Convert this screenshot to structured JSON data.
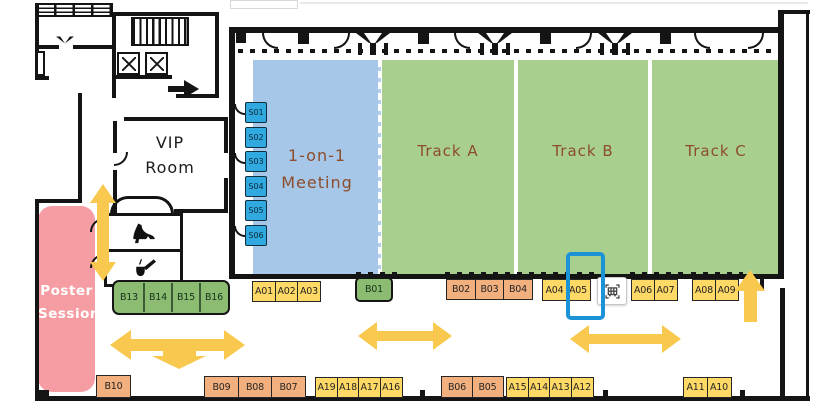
{
  "colors": {
    "wall": "#141414",
    "blue_area": "#A7C7E8",
    "green_area": "#A9CF8F",
    "slot_blue": "#2FA9DF",
    "poster_pink": "#F59DA3",
    "booth_yellow": "#FFD966",
    "booth_orange": "#F2B07E",
    "booth_green": "#8CBC72",
    "arrow_gold": "#F8C94E",
    "highlight_blue": "#1C93D6",
    "label_brown": "#8D4C2C"
  },
  "rooms": {
    "vip": {
      "line1": "VIP",
      "line2": "Room"
    },
    "one_on_one": {
      "line1": "1-on-1",
      "line2": "Meeting"
    },
    "tracks": [
      {
        "label": "Track A"
      },
      {
        "label": "Track B"
      },
      {
        "label": "Track C"
      }
    ],
    "poster": {
      "line1": "Poster",
      "line2": "Session"
    }
  },
  "slots": [
    {
      "label": "S01"
    },
    {
      "label": "S02"
    },
    {
      "label": "S03"
    },
    {
      "label": "S04"
    },
    {
      "label": "S05"
    },
    {
      "label": "S06"
    }
  ],
  "booth_groups": [
    {
      "id": "B13-B16",
      "style": "strip",
      "items": [
        {
          "label": "B13"
        },
        {
          "label": "B14"
        },
        {
          "label": "B15"
        },
        {
          "label": "B16"
        }
      ]
    },
    {
      "id": "A01-A03",
      "style": "yellow",
      "items": [
        {
          "label": "A01"
        },
        {
          "label": "A02"
        },
        {
          "label": "A03"
        }
      ]
    },
    {
      "id": "B01",
      "style": "green",
      "items": [
        {
          "label": "B01"
        }
      ]
    },
    {
      "id": "B02-B04",
      "style": "orange",
      "items": [
        {
          "label": "B02"
        },
        {
          "label": "B03"
        },
        {
          "label": "B04"
        }
      ]
    },
    {
      "id": "A04-A05",
      "style": "yellow",
      "items": [
        {
          "label": "A04"
        },
        {
          "label": "A05"
        }
      ]
    },
    {
      "id": "A06-A07",
      "style": "yellow",
      "items": [
        {
          "label": "A06"
        },
        {
          "label": "A07"
        }
      ]
    },
    {
      "id": "A08-A09",
      "style": "yellow",
      "items": [
        {
          "label": "A08"
        },
        {
          "label": "A09"
        }
      ]
    },
    {
      "id": "B10",
      "style": "orange",
      "items": [
        {
          "label": "B10"
        }
      ]
    },
    {
      "id": "B09-B07",
      "style": "orange",
      "items": [
        {
          "label": "B09"
        },
        {
          "label": "B08"
        },
        {
          "label": "B07"
        }
      ]
    },
    {
      "id": "A19-A16",
      "style": "yellow",
      "items": [
        {
          "label": "A19"
        },
        {
          "label": "A18"
        },
        {
          "label": "A17"
        },
        {
          "label": "A16"
        }
      ]
    },
    {
      "id": "B06-B05",
      "style": "orange",
      "items": [
        {
          "label": "B06"
        },
        {
          "label": "B05"
        }
      ]
    },
    {
      "id": "A15-A12",
      "style": "yellow",
      "items": [
        {
          "label": "A15"
        },
        {
          "label": "A14"
        },
        {
          "label": "A13"
        },
        {
          "label": "A12"
        }
      ]
    },
    {
      "id": "A11-A10",
      "style": "yellow",
      "items": [
        {
          "label": "A11"
        },
        {
          "label": "A10"
        }
      ]
    }
  ],
  "selection": {
    "selected_booth": "A05"
  },
  "icons": {
    "cart": "cart-icon",
    "womens_room": "high-heel-shoe-icon",
    "mens_room": "smoking-pipe-icon",
    "elevator": "elevator-cross-icon"
  }
}
